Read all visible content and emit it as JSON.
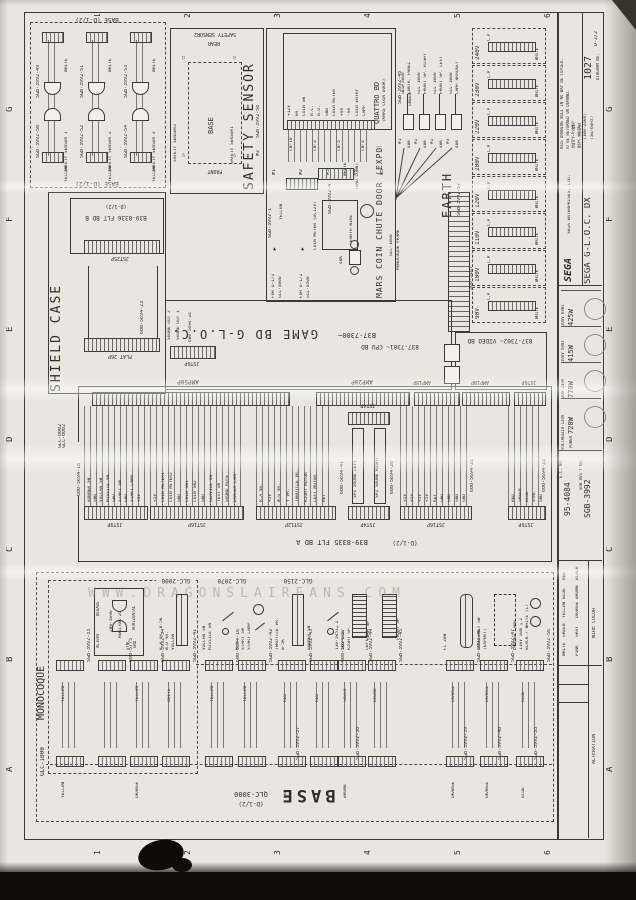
{
  "page": {
    "watermark": "WWW.DRAGONSLAIRFANS.COM"
  },
  "grid": {
    "cols": [
      "1",
      "2",
      "3",
      "4",
      "5",
      "6"
    ],
    "rows": [
      "G",
      "F",
      "E",
      "D",
      "C",
      "B",
      "A"
    ]
  },
  "title_block": {
    "brand": "SEGA",
    "company": "SEGA ENTERPRISES, LTD.",
    "notice1": "THIS DRAWING WILL IN NO WAY BE COPIED.",
    "notice2": "TO BE RETURNED ON DEMAND.",
    "notice_jp1": "許可ナク複写",
    "notice_jp2": "禁ズ 要返却",
    "title": "SEGA G-L.O.C. DX",
    "subtitle1": "(100-240V)",
    "subtitle2": "(50/60Hz)",
    "sheet_no": "1027",
    "sheet_ref": "D-2/2",
    "diagram_no_label": "DIAGRAM No.",
    "ratings": {
      "voltage_label": "VOLTAGE",
      "power_label": "POWER",
      "rows": [
        {
          "voltage": "100V 60Hz",
          "power": "425W"
        },
        {
          "voltage": "100V 50Hz",
          "power": "415W"
        },
        {
          "voltage": "200-240V",
          "power": "770W"
        },
        {
          "voltage": "110-120V",
          "power": "720W"
        }
      ]
    },
    "ec_no": "95-4084",
    "ec_label": "E.C. No.",
    "assy_no": "SGB-3992",
    "assy_label": "SUB ASS'Y No.",
    "wire_color_label": "WIRE COLOR",
    "wire_colors_a": [
      "RED",
      "BLUE",
      "YELLOW",
      "GREEN",
      "WHITE"
    ],
    "wire_colors_b": [
      "BLACK",
      "BROWN",
      "ORANGE",
      "GRAY",
      "PINK"
    ],
    "alteration_label": "ALTERATION"
  },
  "safety": {
    "boundary": "BASE (D-1/2)",
    "columns": [
      {
        "x": 36,
        "part_top": "SGB-3992-49",
        "part_bottom": "SGB-3992-50",
        "name": "SAFETY SENSOR 1",
        "color_top": "WHITE",
        "color_bottom": "YELLOW"
      },
      {
        "x": 80,
        "part_top": "SGB-3992-51",
        "part_bottom": "SGB-3992-52",
        "name": "SAFETY SENSOR 2",
        "color_top": "WHITE",
        "color_bottom": "YELLOW"
      },
      {
        "x": 124,
        "part_top": "SGB-3992-53",
        "part_bottom": "SGB-3992-54",
        "name": "SAFETY SENSOR 3",
        "color_top": "WHITE",
        "color_bottom": "YELLOW"
      }
    ]
  },
  "sensor_layout": {
    "title": "SAFETY SENSOR",
    "part": "SGB-3992-58",
    "tag": "#2",
    "box_label": "BASE",
    "front": "FRONT",
    "rear": "REAR",
    "top": "SAFETY SENSOR2",
    "left": "SAFETY SENSOR3",
    "right": "SAFETY SENSOR1",
    "sym_circle": "○",
    "sym_tri": "△"
  },
  "coin": {
    "board_title": "QUATTRO BD",
    "board_sub": "(MARS COIN DOOR)",
    "pins": [
      "+12V",
      "0V",
      "COIN SW",
      "N.C.",
      "N.O.",
      "GND",
      "COIN METER",
      "+Ve",
      "-Ve",
      "COIN ENTRY",
      "LAMP"
    ],
    "cn": [
      "CN-10",
      "CN-2",
      "CN-5",
      "CN-4"
    ],
    "tags": [
      "#1",
      "#2",
      "#3",
      "#4",
      "#5"
    ],
    "part1": "SGB-3992-1",
    "part2": "SGB-3992-4",
    "color1": "YELLOW",
    "color2": "WHITE",
    "meter": "COIN METER (DC12V)",
    "end_conn": "(END CONN)",
    "earth_wire": "EARTH WIRE",
    "res": "40K",
    "for1a": "FOR D-1/2",
    "for1b": "GLC-4000",
    "for2a": "FOR D-1/2",
    "for2b": "GLC-0500",
    "big_label": "MARS COIN CHUTE DOOR (EXPORT)"
  },
  "earth": {
    "part": "SGB-3992-48",
    "cp": "C.P",
    "green": "GREEN",
    "targets": [
      {
        "tag": "#1",
        "res": "40K",
        "dest": "GLC-2000",
        "dest2": "CONTR. PANEL"
      },
      {
        "tag": "#2",
        "res": "40K",
        "dest": "GLC-1000",
        "dest2": "FRONT SP. RIGHT"
      },
      {
        "tag": "#2",
        "res": "40K",
        "dest": "GLC-1000",
        "dest2": "FRONT SP. LEFT"
      },
      {
        "tag": "#3",
        "res": "40K",
        "dest": "GLC-1000",
        "dest2": "LAMP BRACKET"
      }
    ],
    "source1": "GLC-1000",
    "source2": "MONOCOQUE FRAME",
    "title": "EARTH",
    "part2": "SGB-3992-57"
  },
  "power": {
    "transformer": "560-5167",
    "white": "WHITE",
    "tap_cp": "C.P",
    "tap_color": "WHITE",
    "taps": [
      "240V",
      "230V",
      "220V",
      "200V",
      "120V",
      "110V",
      "100V",
      "90V"
    ]
  },
  "shield": {
    "title": "SHIELD CASE",
    "bd_ref": "(D-1/2)",
    "bd": "B39-8336 FLT BD B",
    "conn_top": "JST25P",
    "cable": "600-5694-23",
    "conn_bottom": "FLAT 26P",
    "part": "GLC-0002",
    "sound1": "SOUND OUT 1",
    "sound2": "SOUND OUT 2",
    "sound_cable": "600-5694-24",
    "sound_conn": "JST6P"
  },
  "gamebd": {
    "title": "GAME BD G-L.O.C.",
    "rev": "B37-7300~",
    "cpu": "837-7301~ CPU BD",
    "video": "837-7302~ VIDEO BD"
  },
  "fltbd": {
    "label": "B39-8335 FLT BD A",
    "ref": "(D-1/2)",
    "part": "GLC-0002",
    "amp_a": "AMP50P",
    "amp_b": "AMP20P",
    "amp_c": "AMP18P",
    "amp_d": "AMP18P",
    "amp_e": "JST6P",
    "jst_a": "JST9P",
    "jst_b": "JST16P",
    "jst_c": "JST12P",
    "jst_d": "JST4P",
    "jst_d2": "JST4P",
    "jst_e": "JST16P",
    "jst_f": "JST6P",
    "cable_18": "600-5694-18",
    "cable_41": "600-5694-41",
    "cable_20": "600-5694-20",
    "cable_21": "600-5694-21",
    "cable_22": "600-5694-22",
    "sound_left": "SP1 SOUND LEFT",
    "sound_right": "SP2 SOUND RIGHT",
    "g1": [
      "BURNER SW",
      "GND",
      "VULCAN SW",
      "MISSILE SW",
      "GND",
      "START SW",
      "GND",
      "START LAMP",
      "+5V"
    ],
    "g2": [
      "+5V",
      "COIN METER1",
      "COIN METER2",
      "GND",
      "COIN SW1",
      "COIN SW2",
      "GND",
      "SERVICE SW",
      "TEST SW",
      "SOUND MUTE",
      "DANGER LAMP"
    ],
    "g3": [
      "R.A VR.",
      "+5V",
      "W.O VR.",
      "Y VR.",
      "THROTTLE VR.",
      "RIGHT MOTOR",
      "LEFT MOTOR",
      "RET"
    ],
    "g4": [
      "+5V",
      "+5V",
      "+5V",
      "+5V",
      "KEY",
      "GND",
      "GND",
      "GND",
      "GND"
    ],
    "g5": [
      "RED",
      "GREEN",
      "BLUE",
      "SYNC",
      "GND"
    ]
  },
  "base": {
    "label": "BASE",
    "part": "QLC-3000",
    "ref": "(D-1/2)",
    "monocoque": "MONOCOQUE",
    "mono_part": "GLC-1000",
    "area1": "GLC-2000",
    "area2": "GLC-2070",
    "area3": "GLC-2150",
    "monitor": {
      "part": "200-5090",
      "name": "MONITOR 26",
      "degauss": "DEGAUS",
      "ac": "AC100V",
      "horizontal": "HORIZONTAL",
      "sync": "SYNC",
      "gnd": "GND"
    },
    "devices": [
      {
        "x": 54,
        "g": "conn",
        "part": "SGB-3992-33",
        "color": "YELLOW",
        "bcolor": "YELLOW"
      },
      {
        "x": 96,
        "g": "dshape",
        "part": "600-5775"
      },
      {
        "x": 128,
        "g": "conn",
        "part": "SGB-3992-34",
        "color": "YELLOW",
        "bcolor": "ORANGE"
      },
      {
        "x": 160,
        "g": "vr",
        "l1": "R.A VR. B-5K",
        "l2": "W.O VR.",
        "l3": "VULCAN",
        "part": "SGB-3992-41",
        "color": "WHITE"
      },
      {
        "x": 203,
        "g": "switch",
        "l1": "VULCAN SW",
        "l2": "MISSILE SW",
        "part": "600-5694-16",
        "color": "YELLOW"
      },
      {
        "x": 236,
        "g": "lampswitch",
        "l1": "N.O.",
        "l2": "START SW",
        "l3": "START LAMP",
        "part": "SGB-3992-42",
        "color": "YELLOW"
      },
      {
        "x": 276,
        "g": "vr",
        "l1": "THROTTLE VR.",
        "l2": "B-5K",
        "part": "SGB-3992-43",
        "color": "RED",
        "bpart": "SGB-3992-37",
        "bcolor": "RED"
      },
      {
        "x": 308,
        "g": "switch",
        "l1": "BURNER SW",
        "part": "600-5694-17",
        "color": "RED"
      },
      {
        "x": 336,
        "g": "speaker",
        "l1": "130-5051×2",
        "l2": "16Ω 10W",
        "l3": "RIGHT SP.",
        "l4": "REAR SP",
        "part": "SGB-3992-44",
        "color": "GREEN",
        "bpart": "SGB-3992-38",
        "bcolor": "BROWN"
      },
      {
        "x": 366,
        "g": "speaker",
        "l1": "LEFT SP.",
        "l4": "FRONT SP",
        "part": "SGB-3992-45",
        "color": "BROWN"
      },
      {
        "x": 444,
        "g": "fl",
        "l1": "FL 20W",
        "part": "SGB-3992-46",
        "color": "ORANGE",
        "bpart": "SGB-3992-39",
        "bcolor": "ORANGE"
      },
      {
        "x": 478,
        "g": "dashed",
        "l1": "EMERGENCY SW",
        "l2": "(EXPORT)",
        "part": "SGB-3992-47",
        "color": "ORANGE",
        "bpart": "SGB-3992-40",
        "bcolor": "ORANGE"
      },
      {
        "x": 514,
        "g": "lamps",
        "l1": "DANGER LAMP",
        "l2": "110V 10W ×2",
        "l3": "BLACK / WHITE (L)",
        "part": "SGB-3992-56",
        "color": "BLUE",
        "bpart": "SGB-3992-55",
        "bcolor": "BLUE"
      }
    ]
  }
}
